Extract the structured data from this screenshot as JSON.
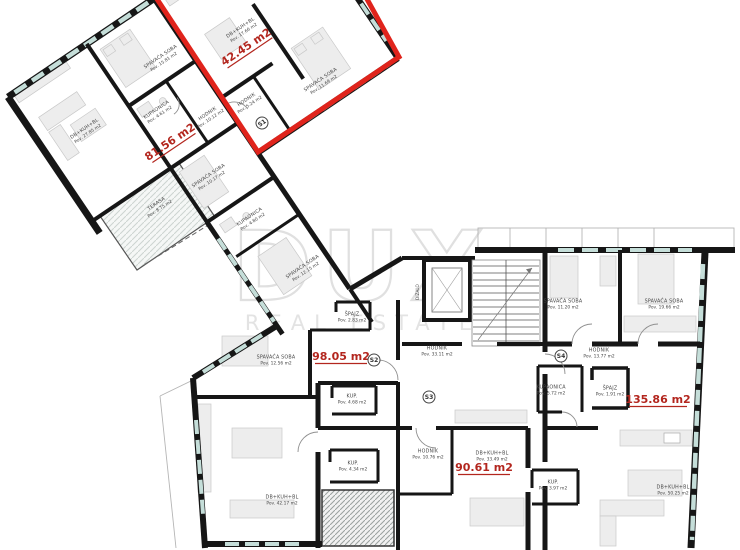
{
  "watermark": {
    "brand": "DUX",
    "tagline": "REAL ESTATE"
  },
  "unit_areas": [
    {
      "label": "42.45 m2"
    },
    {
      "label": "81.56 m2"
    },
    {
      "label": "98.05 m2"
    },
    {
      "label": "135.86 m2"
    },
    {
      "label": "90.61 m2"
    }
  ],
  "rooms": [
    {
      "name": "DB+KUH+BL",
      "area": "Pov. 17.66 m2"
    },
    {
      "name": "SPAVAĆA SOBA",
      "area": "Pov. 11.69 m2"
    },
    {
      "name": "HODNIK",
      "area": "Pov. 5.24 m2"
    },
    {
      "name": "HODNIK",
      "area": "Pov. 10.12 m2"
    },
    {
      "name": "SPAVAĆA SOBA",
      "area": "Pov. 15.81 m2"
    },
    {
      "name": "KUPAONICA",
      "area": "Pov. 4.61 m2"
    },
    {
      "name": "DB+KUH+BL",
      "area": "Pov. 27.85 m2"
    },
    {
      "name": "TERASA",
      "area": "Pov. 8.75 m2"
    },
    {
      "name": "SPAVAĆA SOBA",
      "area": "Pov. 10.17 m2"
    },
    {
      "name": "KUPAONICA",
      "area": "Pov. 4.80 m2"
    },
    {
      "name": "SPAVAĆA SOBA",
      "area": "Pov. 12.15 m2"
    },
    {
      "name": "SPAVAĆA SOBA",
      "area": "Pov. 12.56 m2"
    },
    {
      "name": "ŠPAJZ",
      "area": "Pov. 2.83 m2"
    },
    {
      "name": "HODNIK",
      "area": "Pov. 33.11 m2"
    },
    {
      "name": "SPAVAĆA SOBA",
      "area": "Pov. 11.20 m2"
    },
    {
      "name": "SPAVAĆA SOBA",
      "area": "Pov. 19.66 m2"
    },
    {
      "name": "HODNIK",
      "area": "Pov. 13.77 m2"
    },
    {
      "name": "KUPAONICA",
      "area": "Pov. 5.72 m2"
    },
    {
      "name": "ŠPAJZ",
      "area": "Pov. 1.91 m2"
    },
    {
      "name": "KUP.",
      "area": "Pov. 4.68 m2"
    },
    {
      "name": "HODNIK",
      "area": "Pov. 10.76 m2"
    },
    {
      "name": "DB+KUH+BL",
      "area": "Pov. 33.49 m2"
    },
    {
      "name": "KUP.",
      "area": "Pov. 4.34 m2"
    },
    {
      "name": "KUP.",
      "area": "Pov. 3.97 m2"
    },
    {
      "name": "DB+KUH+BL",
      "area": "Pov. 42.17 m2"
    },
    {
      "name": "DB+KUH+BL",
      "area": "Pov. 50.25 m2"
    }
  ],
  "badges": [
    {
      "label": "S1"
    },
    {
      "label": "S2"
    },
    {
      "label": "S3"
    },
    {
      "label": "S4"
    }
  ],
  "core": {
    "elevator_label": "DIZALO"
  },
  "colors": {
    "outline_red": "#e0241c",
    "area_label_red": "#b3261e",
    "wall_black": "#161616",
    "window_teal": "#c5ded9"
  }
}
